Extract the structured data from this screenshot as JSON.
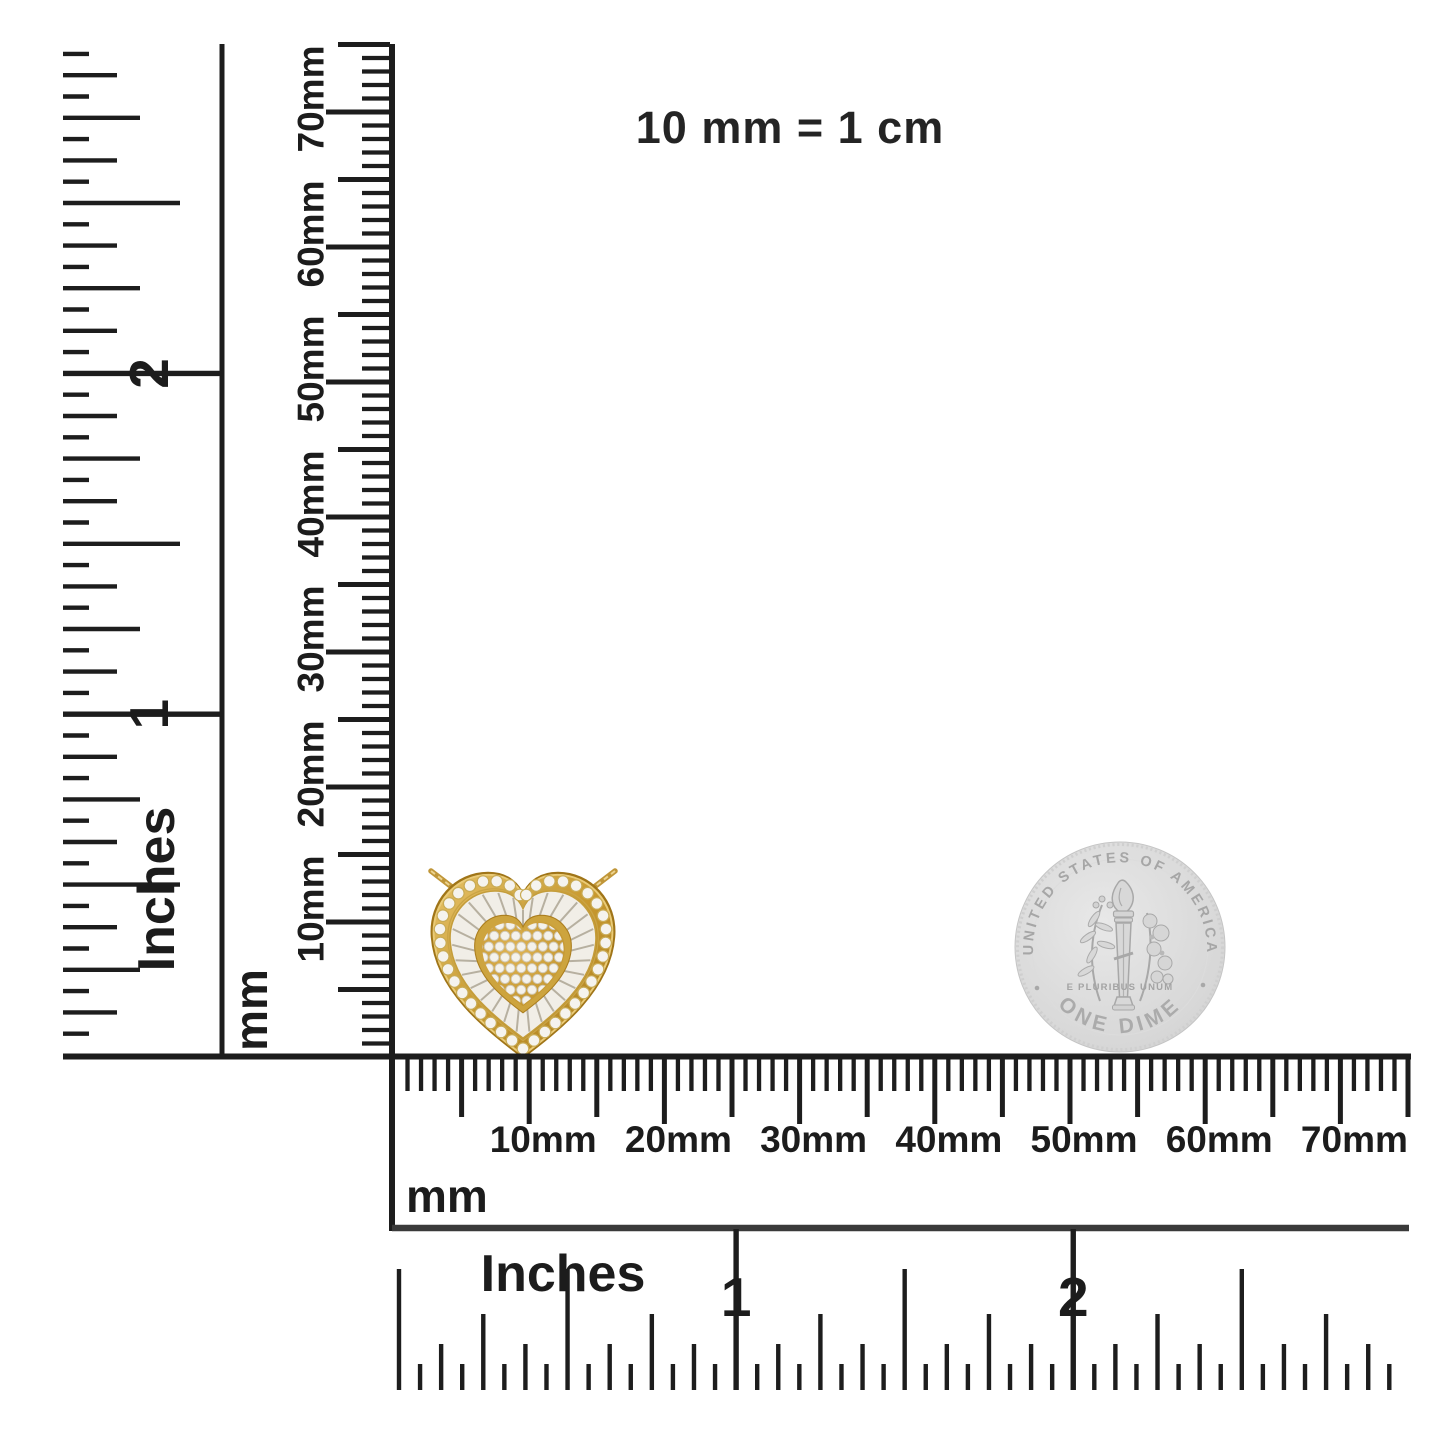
{
  "note": {
    "text": "10 mm = 1 cm"
  },
  "rulers": {
    "left_inches": {
      "unit": "Inches",
      "numbers": [
        "1",
        "2"
      ]
    },
    "left_mm": {
      "unit": "mm",
      "labels": [
        "10mm",
        "20mm",
        "30mm",
        "40mm",
        "50mm",
        "60mm",
        "70mm"
      ]
    },
    "bottom_mm": {
      "unit": "mm",
      "labels": [
        "10mm",
        "20mm",
        "30mm",
        "40mm",
        "50mm",
        "60mm",
        "70mm"
      ]
    },
    "bottom_inches": {
      "unit": "Inches",
      "numbers": [
        "1",
        "2"
      ]
    }
  },
  "pendant": {
    "description": "yellow gold heart pendant with round diamond halo, baguette ring and pave heart center, on gold chain",
    "metal_color": "#c8992f",
    "metal_light": "#e3bd62",
    "metal_dark": "#a07518",
    "stone_color": "#f5f3ee",
    "baguette_field": "#f1eee7",
    "baguette_line": "#b7b0a0"
  },
  "coin": {
    "top_text": "UNITED STATES OF AMERICA",
    "bottom_text": "ONE DIME",
    "motto": "E PLURIBUS UNUM",
    "color": "#d8d8d8"
  },
  "colors": {
    "ink": "#1d1d1d",
    "inch_spine": "#3a3a3a",
    "background": "#ffffff"
  }
}
